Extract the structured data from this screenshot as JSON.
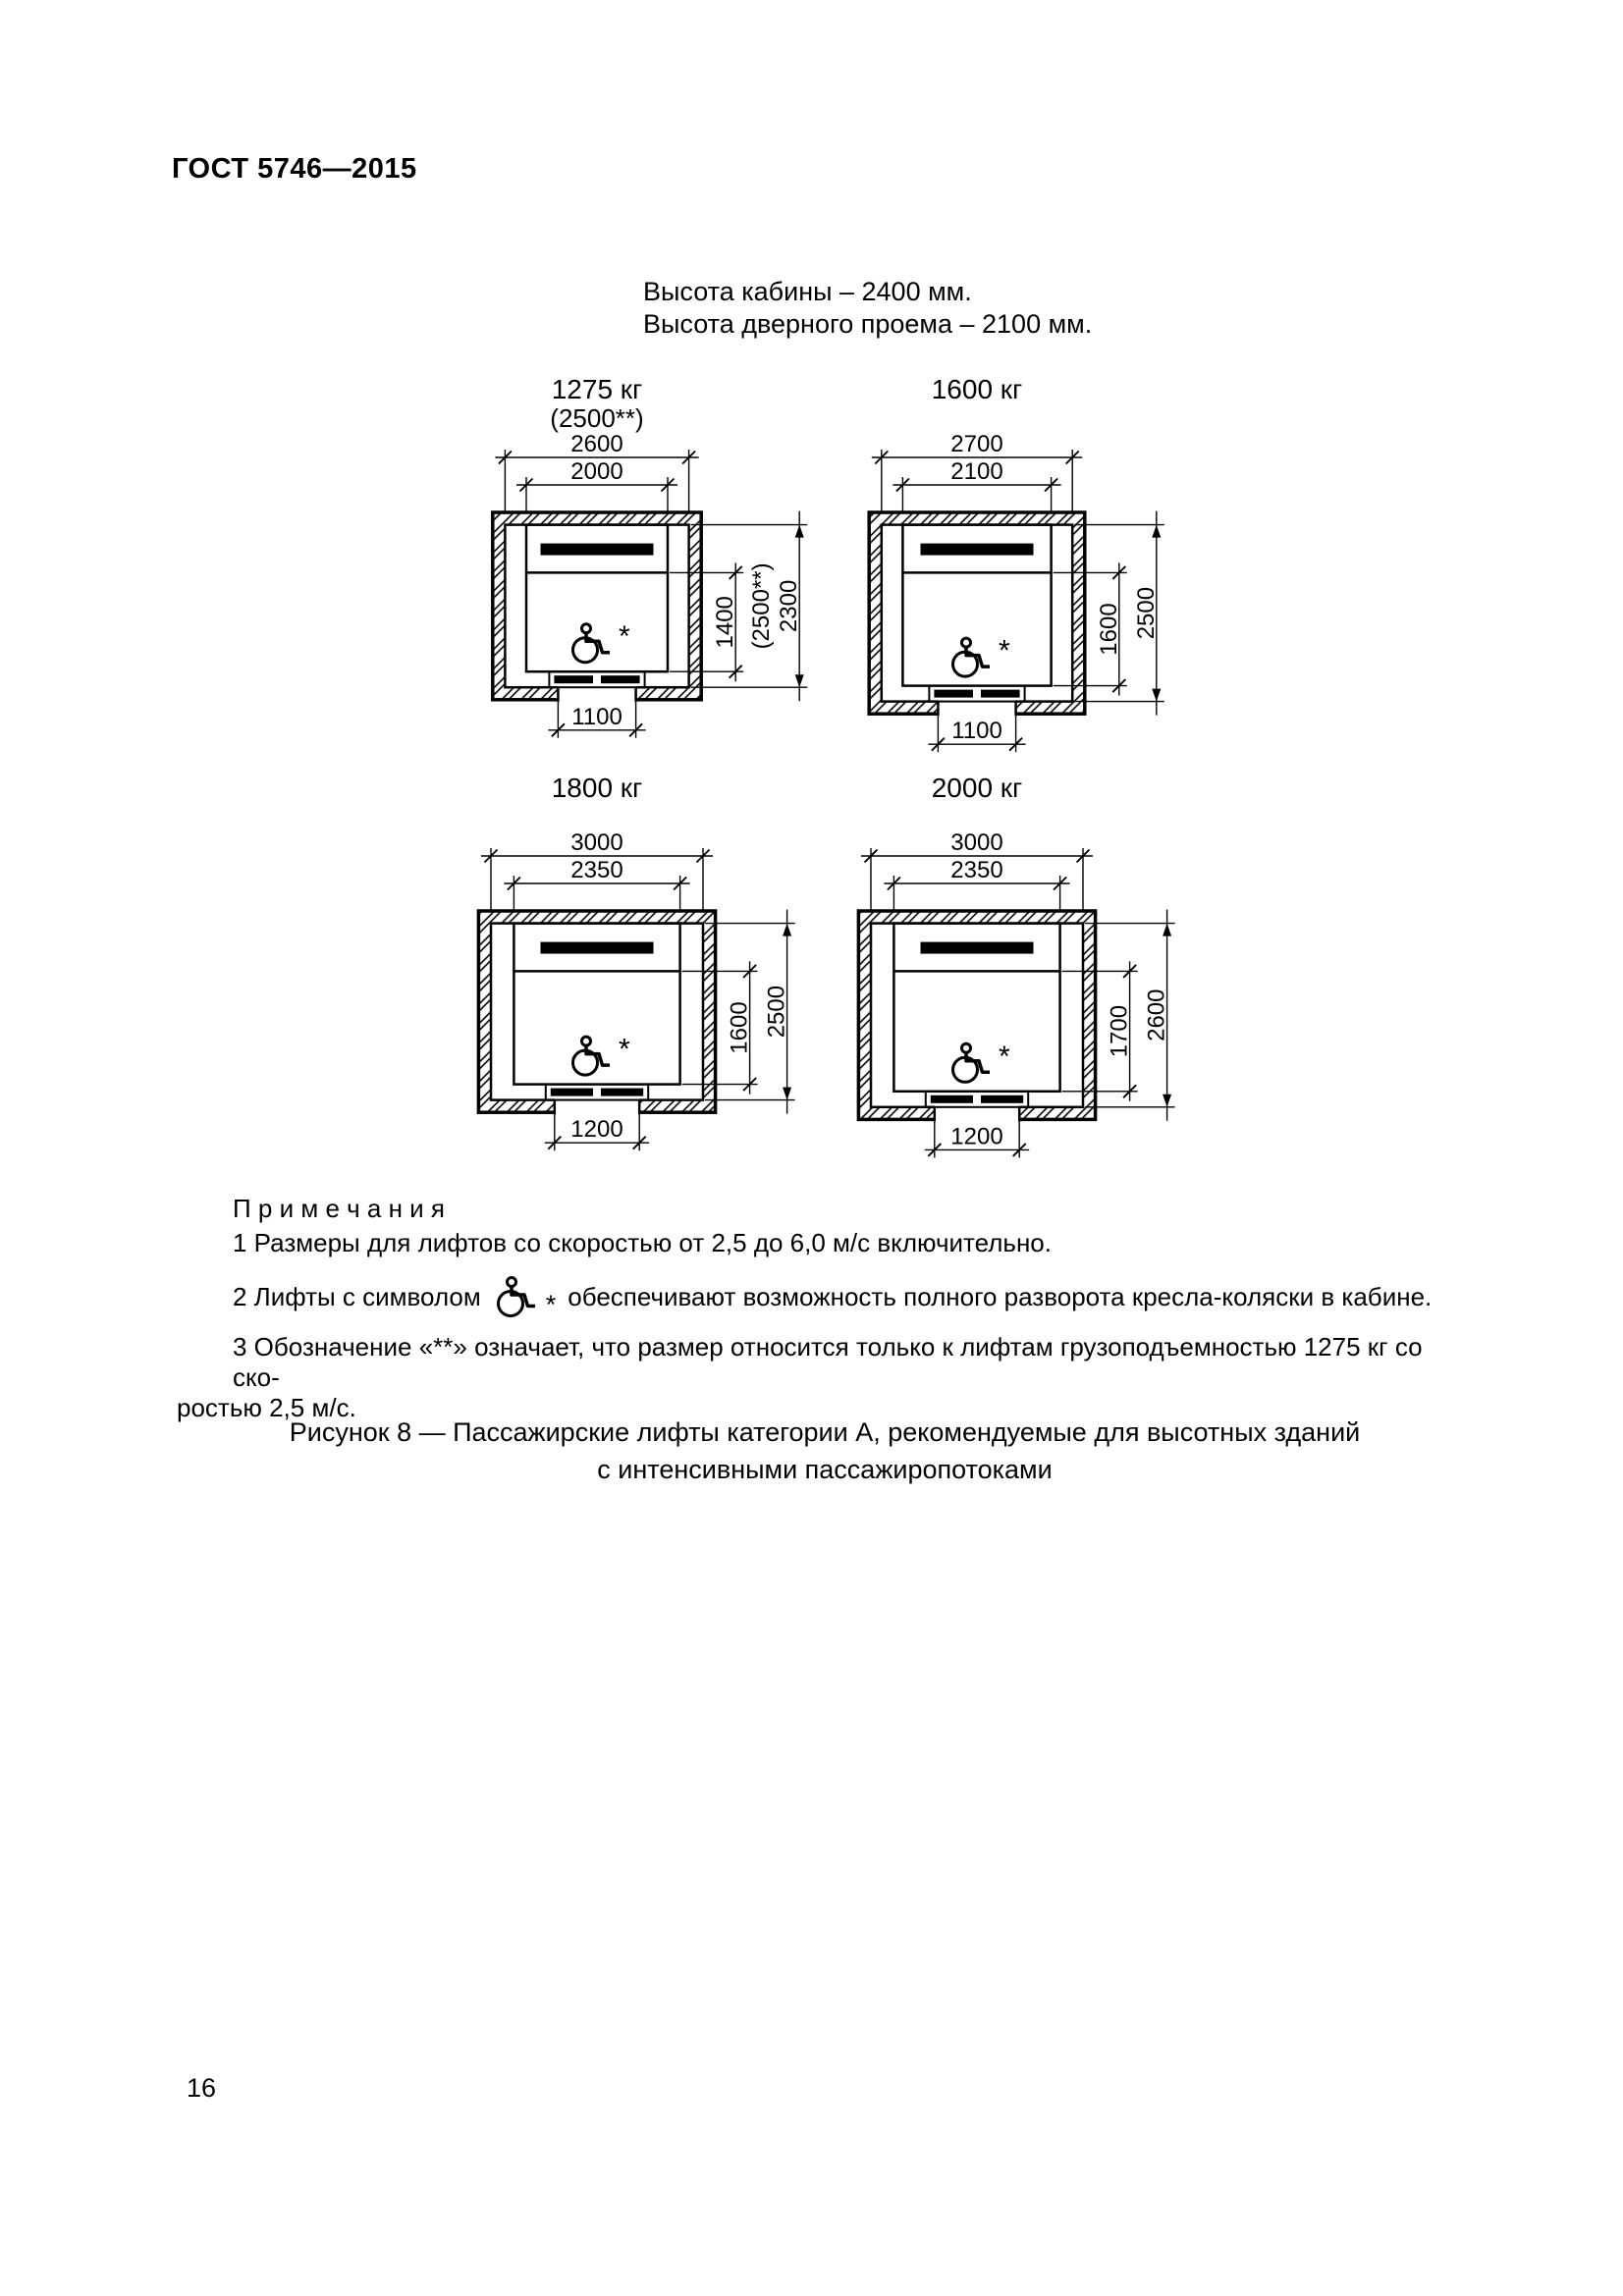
{
  "page": {
    "header": "ГОСТ 5746—2015",
    "page_number": "16",
    "intro_line1": "Высота кабины – 2400 мм.",
    "intro_line2": "Высота дверного проема – 2100 мм.",
    "notes": {
      "heading": "П р и м е ч а н и я",
      "note1": "1  Размеры для лифтов со скоростью от 2,5 до 6,0 м/с включительно.",
      "note2_prefix": "2  Лифты с символом",
      "note2_asterisk": "*",
      "note2_suffix": "обеспечивают возможность полного разворота кресла-коляски в кабине.",
      "note3_line1": "3  Обозначение «**» означает, что размер относится только к лифтам грузоподъемностью 1275 кг со ско-",
      "note3_line2": "ростью 2,5 м/с."
    },
    "caption_line1": "Рисунок 8 —  Пассажирские лифты категории А, рекомендуемые для высотных зданий",
    "caption_line2": "с интенсивными пассажиропотоками"
  },
  "diagrams": [
    {
      "title": "1275 кг",
      "subtitle": "(2500**)",
      "shaft_width_mm": 2600,
      "cabin_width_mm": 2000,
      "cabin_depth_mm": 1400,
      "shaft_depth_mm": 2300,
      "door_width_mm": 1100,
      "labels": {
        "shaft_width": "2600",
        "cabin_width": "2000",
        "cabin_depth": "1400",
        "shaft_depth": "2300",
        "shaft_depth_alt": "(2500**)",
        "door_width": "1100",
        "asterisk": "*"
      }
    },
    {
      "title": "1600 кг",
      "subtitle": "",
      "shaft_width_mm": 2700,
      "cabin_width_mm": 2100,
      "cabin_depth_mm": 1600,
      "shaft_depth_mm": 2500,
      "door_width_mm": 1100,
      "labels": {
        "shaft_width": "2700",
        "cabin_width": "2100",
        "cabin_depth": "1600",
        "shaft_depth": "2500",
        "shaft_depth_alt": null,
        "door_width": "1100",
        "asterisk": "*"
      }
    },
    {
      "title": "1800 кг",
      "subtitle": "",
      "shaft_width_mm": 3000,
      "cabin_width_mm": 2350,
      "cabin_depth_mm": 1600,
      "shaft_depth_mm": 2500,
      "door_width_mm": 1200,
      "labels": {
        "shaft_width": "3000",
        "cabin_width": "2350",
        "cabin_depth": "1600",
        "shaft_depth": "2500",
        "shaft_depth_alt": null,
        "door_width": "1200",
        "asterisk": "*"
      }
    },
    {
      "title": "2000 кг",
      "subtitle": "",
      "shaft_width_mm": 3000,
      "cabin_width_mm": 2350,
      "cabin_depth_mm": 1700,
      "shaft_depth_mm": 2600,
      "door_width_mm": 1200,
      "labels": {
        "shaft_width": "3000",
        "cabin_width": "2350",
        "cabin_depth": "1700",
        "shaft_depth": "2600",
        "shaft_depth_alt": null,
        "door_width": "1200",
        "asterisk": "*"
      }
    }
  ]
}
